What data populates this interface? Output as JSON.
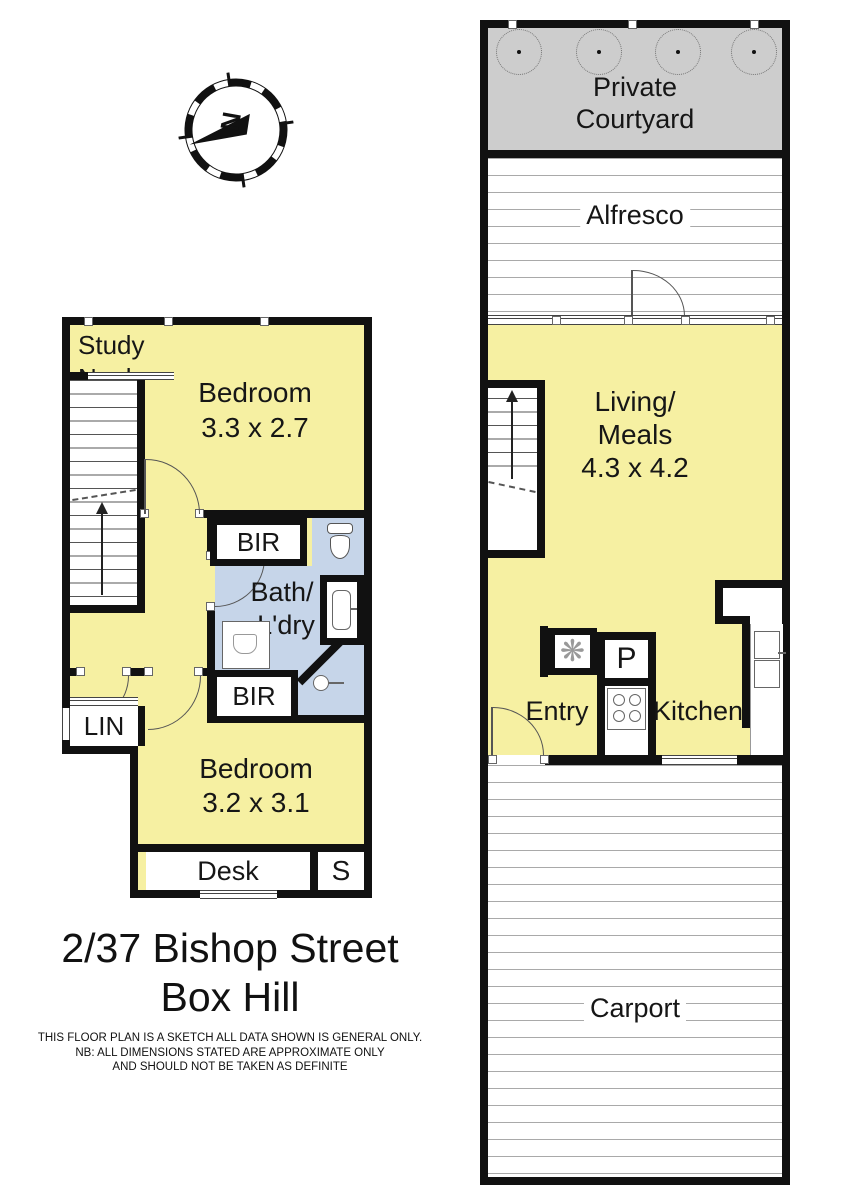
{
  "meta": {
    "address_line1": "2/37 Bishop Street",
    "address_line2": "Box Hill"
  },
  "disclaimer": {
    "line1": "THIS FLOOR PLAN IS A SKETCH ALL DATA SHOWN IS GENERAL ONLY.",
    "line2": "NB: ALL DIMENSIONS STATED ARE APPROXIMATE ONLY",
    "line3": "AND SHOULD NOT BE TAKEN AS DEFINITE"
  },
  "compass": {
    "north_label": "N"
  },
  "colors": {
    "room_fill": "#F6F0A2",
    "wet_area_fill": "#C6D5E9",
    "courtyard_fill": "#CDCDCD",
    "wall": "#111111"
  },
  "upper_floor": {
    "study_nook_line1": "Study",
    "study_nook_line2": "Nook",
    "bedroom1_name": "Bedroom",
    "bedroom1_dims": "3.3 x 2.7",
    "bir_top": "BIR",
    "bath_line1": "Bath/",
    "bath_line2": "L'dry",
    "bir_bottom": "BIR",
    "linen": "LIN",
    "bedroom2_name": "Bedroom",
    "bedroom2_dims": "3.2 x 3.1",
    "desk": "Desk",
    "store": "S"
  },
  "ground_floor": {
    "courtyard_line1": "Private",
    "courtyard_line2": "Courtyard",
    "alfresco": "Alfresco",
    "living_line1": "Living/",
    "living_line2": "Meals",
    "living_dims": "4.3 x 4.2",
    "entry": "Entry",
    "pantry": "P",
    "kitchen": "Kitchen",
    "carport": "Carport"
  }
}
